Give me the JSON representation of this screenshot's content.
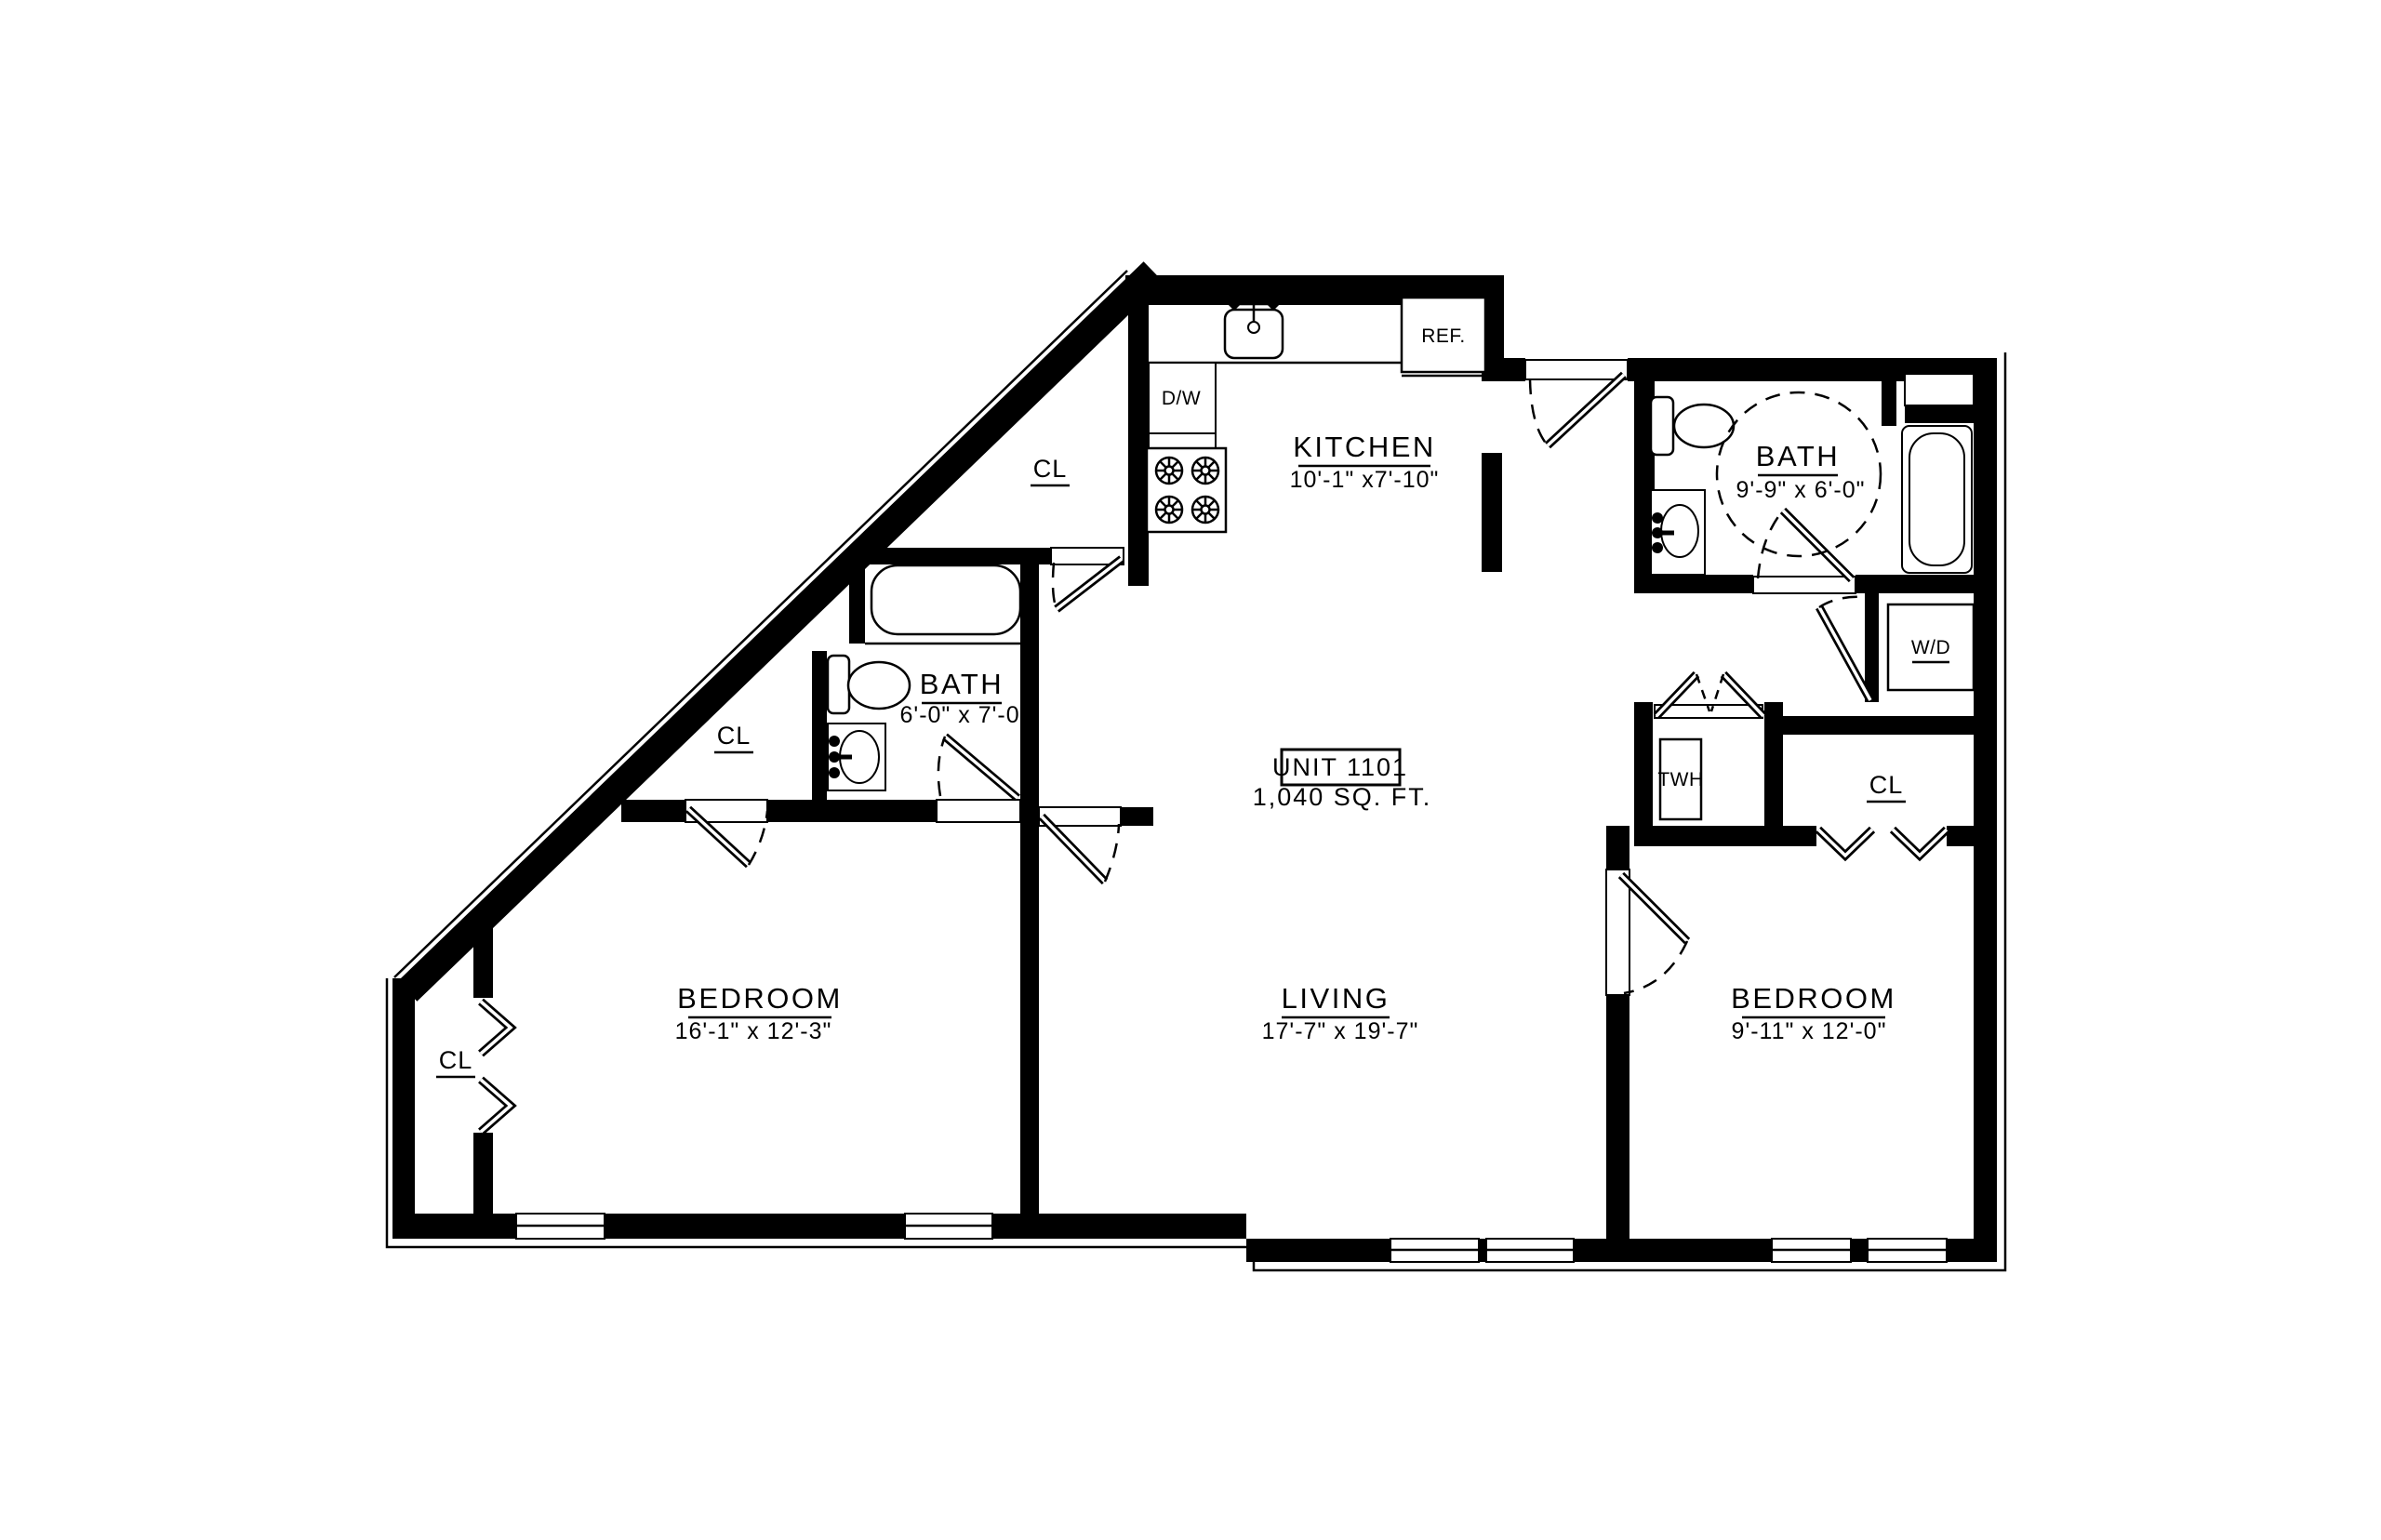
{
  "unit": {
    "number": "UNIT 1101",
    "area": "1,040 SQ. FT."
  },
  "rooms": {
    "kitchen": {
      "label": "KITCHEN",
      "dims": "10'-1\" x7'-10\""
    },
    "living": {
      "label": "LIVING",
      "dims": "17'-7\" x 19'-7\""
    },
    "bedroom_left": {
      "label": "BEDROOM",
      "dims": "16'-1\" x 12'-3\""
    },
    "bedroom_right": {
      "label": "BEDROOM",
      "dims": "9'-11\" x 12'-0\""
    },
    "bath_left": {
      "label": "BATH",
      "dims": "6'-0\" x 7'-0\""
    },
    "bath_right": {
      "label": "BATH",
      "dims": "9'-9\" x 6'-0\""
    },
    "closet_kitchen": {
      "label": "CL"
    },
    "closet_hall": {
      "label": "CL"
    },
    "closet_bedroom_left": {
      "label": "CL"
    },
    "closet_bedroom_right": {
      "label": "CL"
    }
  },
  "fixtures": {
    "refrigerator": "REF.",
    "dishwasher": "D/W",
    "washer_dryer": "W/D",
    "water_heater": "TWH"
  },
  "colors": {
    "wall": "#000000",
    "background": "#ffffff"
  }
}
